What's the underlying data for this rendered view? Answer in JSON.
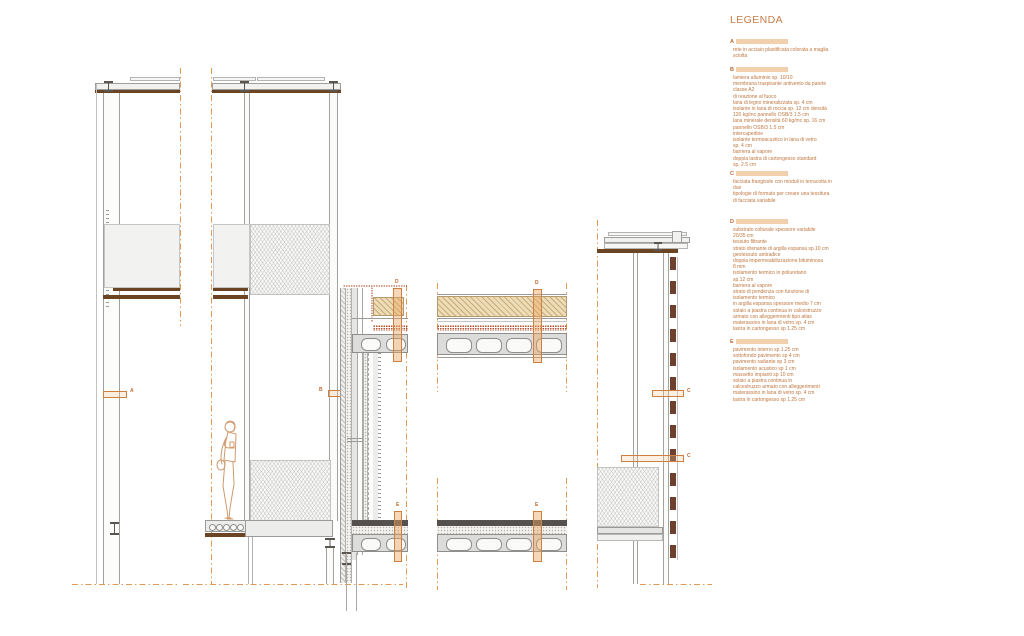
{
  "legend": {
    "title": "LEGENDA",
    "sections": [
      {
        "id": "A",
        "text": "rete in acciaio plastificata colorata a maglia\nsciolta"
      },
      {
        "id": "B",
        "text": "lamiera alluminio sp. 10/10\nmembrana traspirante antivento da parete\nclasse A2\ndi reazione al fuoco\nlana di legno mineralizzata sp. 4 cm\nisolante in lana di roccia sp. 12 cm densità\n120 kg/mc pannello OSB/3 1.5 cm\nlana minerale densità 60 kg/mc sp. 16 cm\npannello OSB/3 1.5 cm\nintercapedine\nisolante termoacustico in lana di vetro\nsp. 4 cm\nbarriera al vapore\ndoppia lastra di cartongesso standard\nsp. 2.5 cm"
      },
      {
        "id": "C",
        "text": "facciata frangisole con moduli in terracotta in\ndue\ntipologie di formato per creare una tessitura\ndi facciata variabile"
      },
      {
        "id": "D",
        "text": "substrato colturale spessore variabile\n20/35 cm\ntessuto filtrante\nstrato drenante di argilla espansa sp.10 cm\ngeotessuto antiradice\ndoppia impermeabilizzazione bituminosa\n8 mm\nisolamento termico in poliuretano\nsp.12 cm\nbarriera al vapore\nstrato di pendenza con funzione di\nisolamento termico\nin argilla espansa spessore medio 7 cm\nsolaio a piastra continua in calcestruzzo\narmato con alleggerimenti tipo atlas\nmaterassino in lana di vetro sp. 4 cm\nlastra in cartongesso sp 1.25 cm"
      },
      {
        "id": "E",
        "text": "pavimento interno sp 1.25 cm\nsottofondo pavimento sp 4 cm\npavimento radiante sp 3 cm\nisolamento acustico sp 1 cm\nmassetto impianti sp 10 cm\nsolaio a piastra continua in\ncalcestruzzo armato con alleggerimenti\nmaterassino in lana di vetro sp. 4 cm\nlastra in cartongesso sp 1.25 cm"
      }
    ]
  },
  "markers": {
    "a": "A",
    "b": "B",
    "c1": "C",
    "c2": "C",
    "d1": "D",
    "d2": "D",
    "e1": "E",
    "e2": "E"
  },
  "colors": {
    "accent": "#D08248",
    "section_line": "#E09A58",
    "slab_brown": "#6B4423",
    "terracotta": "#70402E"
  }
}
